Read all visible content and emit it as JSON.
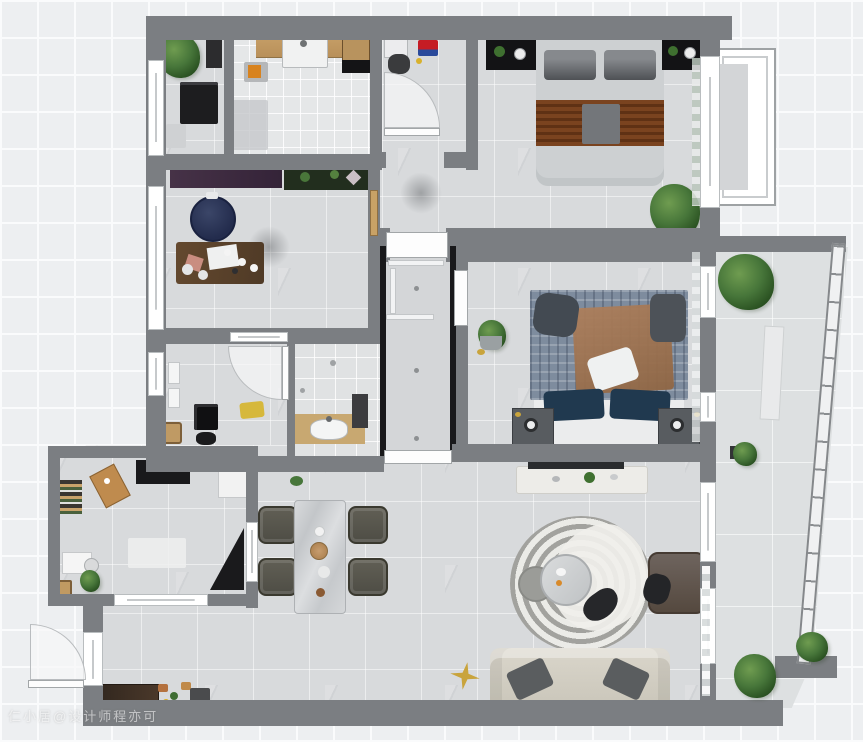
{
  "watermark": {
    "text": "仁小居@设计师程亦可"
  },
  "palette": {
    "canvas": "#edeff1",
    "grid_line": "#fafbfc",
    "wall": "#7b7e82",
    "dark_wall": "#19191b",
    "floor": "#d8dadc",
    "kitchen_tile": "#e5e7e8",
    "wood": "#c9a36b",
    "navy": "#232c4d",
    "purple_cabinet": "#463247",
    "plant_green": "#3f7030",
    "throw_brown": "#7a431f",
    "plaid_blue": "#7e8c9e",
    "sofa_beige": "#d5d1c5",
    "gold": "#c9a43c",
    "accent_red": "#c01822",
    "mat_yellow": "#d6b83c",
    "window_white": "#ffffff"
  },
  "plan": {
    "type": "residential apartment floor plan, top-down furnished 3D render",
    "rooms": [
      {
        "id": "laundry-room",
        "furniture": [
          "potted-plant",
          "washing-machine",
          "storage-cabinet",
          "floor-mat"
        ]
      },
      {
        "id": "kitchen",
        "furniture": [
          "counter-with-sink",
          "faucet",
          "island-cabinet",
          "cooktop",
          "cutting-board",
          "floor-mat"
        ]
      },
      {
        "id": "kids-room",
        "furniture": [
          "desk",
          "chair",
          "red-toy-box",
          "swing-door"
        ]
      },
      {
        "id": "bedroom-2",
        "furniture": [
          "double-bed",
          "headboard",
          "gray-pillows",
          "brown-throw",
          "wardrobe-left",
          "wardrobe-right",
          "bedside-lamps",
          "potted-plant",
          "bay-window",
          "curtain"
        ]
      },
      {
        "id": "tea-room",
        "furniture": [
          "purple-sideboard",
          "display-shelf",
          "round-lounge-chair",
          "tea-table",
          "tea-set",
          "floor-cushions"
        ]
      },
      {
        "id": "bathroom",
        "furniture": [
          "swing-door",
          "storage-shelves",
          "washer",
          "wood-stool",
          "yellow-mat",
          "chair"
        ]
      },
      {
        "id": "shower-room",
        "furniture": [
          "vanity",
          "basin",
          "storage-rack",
          "floor-drain"
        ]
      },
      {
        "id": "hallway",
        "furniture": [
          "double-doors",
          "closet-panels",
          "ceiling-lights"
        ]
      },
      {
        "id": "master-bedroom",
        "furniture": [
          "double-bed",
          "plaid-blanket",
          "navy-pillows",
          "white-pillow",
          "nightstand-left",
          "nightstand-right",
          "plant-basket",
          "curtain",
          "wall-tv"
        ]
      },
      {
        "id": "living-room",
        "furniture": [
          "tv-console",
          "round-striped-rug",
          "coffee-table",
          "floor-cushion",
          "armchair",
          "sofa",
          "throw-pillows",
          "star-ornament",
          "sheer-curtain",
          "sliding-glass-door"
        ]
      },
      {
        "id": "dining-area",
        "furniture": [
          "marble-dining-table",
          "dining-chair-1",
          "dining-chair-2",
          "dining-chair-3",
          "dining-chair-4",
          "tableware",
          "potted-plant"
        ]
      },
      {
        "id": "study",
        "furniture": [
          "media-panel",
          "white-cabinet",
          "bookshelf",
          "wooden-board",
          "corner-black-desk",
          "writing-desk",
          "chair",
          "potted-plant",
          "rug",
          "wood-stool",
          "sliding-window"
        ]
      },
      {
        "id": "foyer",
        "furniture": [
          "entry-door",
          "shoe-cabinet",
          "shoes",
          "storage-box"
        ]
      },
      {
        "id": "balcony",
        "furniture": [
          "glazed-curved-wall",
          "planter-box",
          "potted-plants"
        ]
      }
    ]
  }
}
